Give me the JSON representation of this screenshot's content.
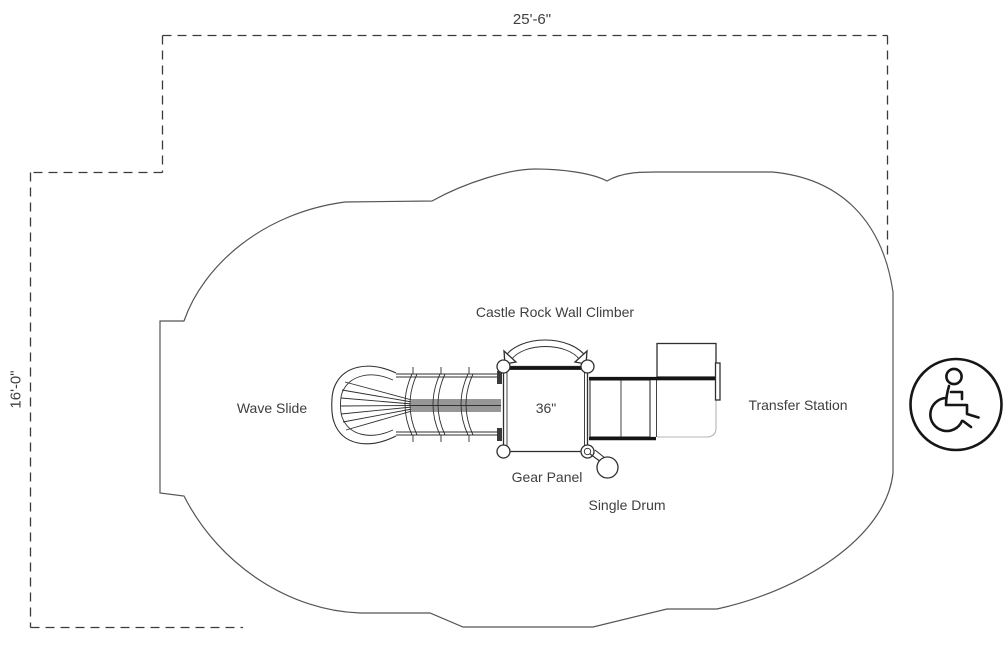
{
  "dimensions": {
    "width_label": "25'-6\"",
    "height_label": "16'-0\""
  },
  "equipment": {
    "climber_label": "Castle Rock Wall Climber",
    "wave_slide_label": "Wave Slide",
    "deck_size_label": "36\"",
    "transfer_station_label": "Transfer Station",
    "gear_panel_label": "Gear Panel",
    "single_drum_label": "Single Drum"
  },
  "icons": {
    "accessibility": "wheelchair-accessible-icon"
  },
  "colors": {
    "line": "#2f2f2f",
    "dashed_boundary": "#3a3a3a",
    "use_zone_outline": "#555555",
    "text": "#3f3f3f",
    "light_line": "#b5b5b5",
    "background": "#ffffff"
  }
}
